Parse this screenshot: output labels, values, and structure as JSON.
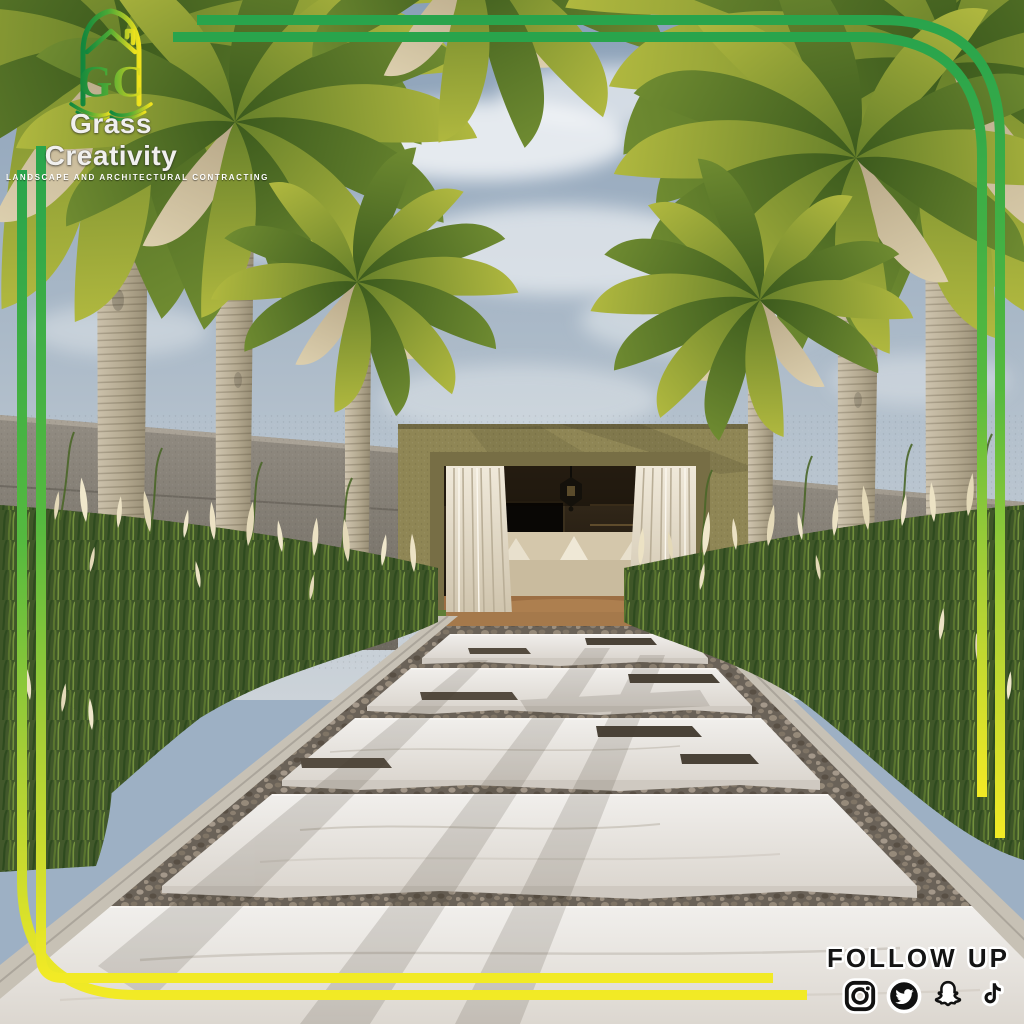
{
  "brand": {
    "monogram": "GC",
    "name": "Grass Creativity",
    "tagline": "LANDSCAPE AND ARCHITECTURAL CONTRACTING"
  },
  "footer": {
    "label": "FOLLOW UP",
    "icons": [
      "instagram",
      "twitter",
      "snapchat",
      "tiktok"
    ]
  },
  "scene": {
    "alt": "3D landscape render: palm-lined white marble plank walkway with pebble joints leading to an olive-stucco garden room with white curtains and a hanging lantern, pampas grass beds, grey perimeter wall, cloudy blue sky"
  },
  "colors": {
    "frame_green": "#2aa84d",
    "frame_yellow": "#f2ea28",
    "logo_green": "#12873d",
    "logo_yellow": "#f0e31d",
    "pavilion_stucco": "#8f8655",
    "curtain": "#e8e0d0",
    "marble": "#e9e6e1",
    "pebble": "#6a6258",
    "sky": "#9db0c4",
    "grass": "#3f5628",
    "plume": "#ece2c4",
    "wall": "#837d74",
    "icon_black": "#111111",
    "text_white": "#f2f2f2"
  }
}
